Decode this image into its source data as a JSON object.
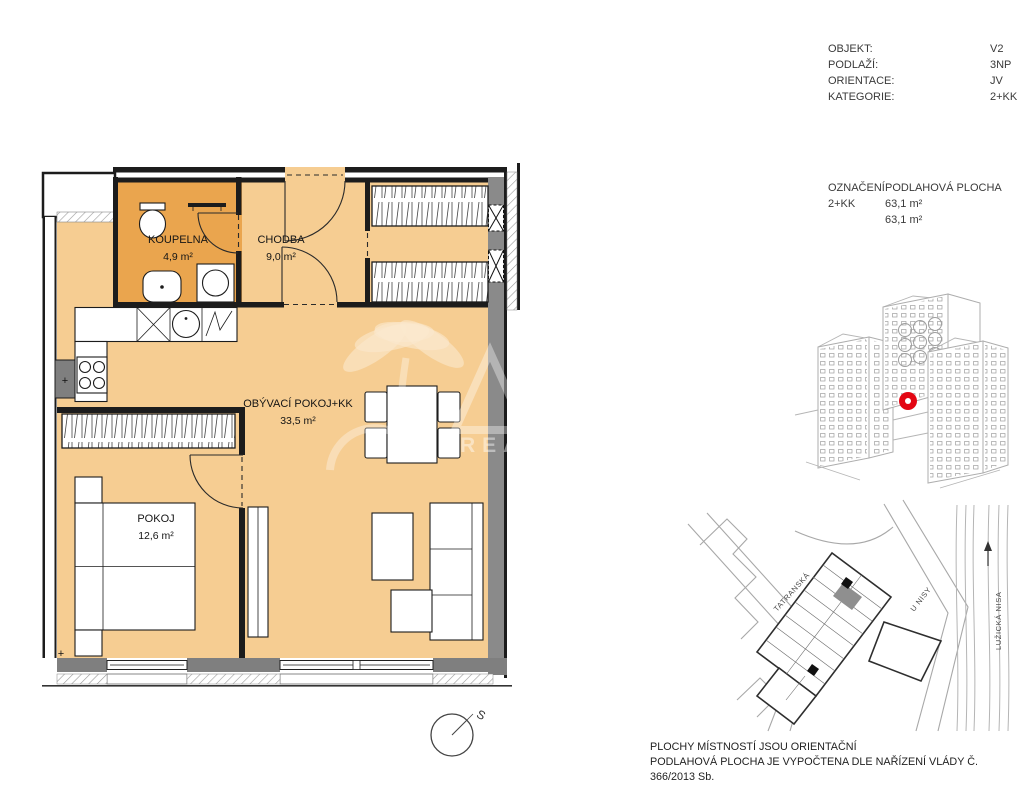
{
  "info_panel": {
    "rows": [
      {
        "label": "OBJEKT:",
        "value": "V2"
      },
      {
        "label": "PODLAŽÍ:",
        "value": "3NP"
      },
      {
        "label": "ORIENTACE:",
        "value": "JV"
      },
      {
        "label": "KATEGORIE:",
        "value": "2+KK"
      }
    ]
  },
  "area_panel": {
    "col1_header": "OZNAČENÍ",
    "col2_header": "PODLAHOVÁ PLOCHA",
    "designation": "2+KK",
    "areas": [
      "63,1 m²",
      "63,1 m²"
    ]
  },
  "floor_plan": {
    "rooms": [
      {
        "name": "KOUPELNA",
        "area": "4,9 m²"
      },
      {
        "name": "CHODBA",
        "area": "9,0 m²"
      },
      {
        "name": "OBÝVACÍ POKOJ+KK",
        "area": "33,5 m²"
      },
      {
        "name": "POKOJ",
        "area": "12,6 m²"
      }
    ],
    "compass_label": "S",
    "column_marks": [
      "+",
      "+"
    ]
  },
  "site_map": {
    "street_labels": [
      "TATRANSKÁ",
      "U NISY",
      "LUŽICKÁ NISA"
    ]
  },
  "watermark": {
    "visible_text": "REA"
  },
  "footer": {
    "lines": [
      "PLOCHY MÍSTNOSTÍ JSOU ORIENTAČNÍ",
      "PODLAHOVÁ PLOCHA JE VYPOČTENA DLE NAŘÍZENÍ VLÁDY Č. 366/2013 Sb."
    ]
  },
  "colors": {
    "room_fill": "#f6cd92",
    "bathroom_fill": "#eaa54e",
    "wall": "#1c1c1c",
    "exterior_gray": "#7f7f7f",
    "marker_red": "#e30613"
  }
}
